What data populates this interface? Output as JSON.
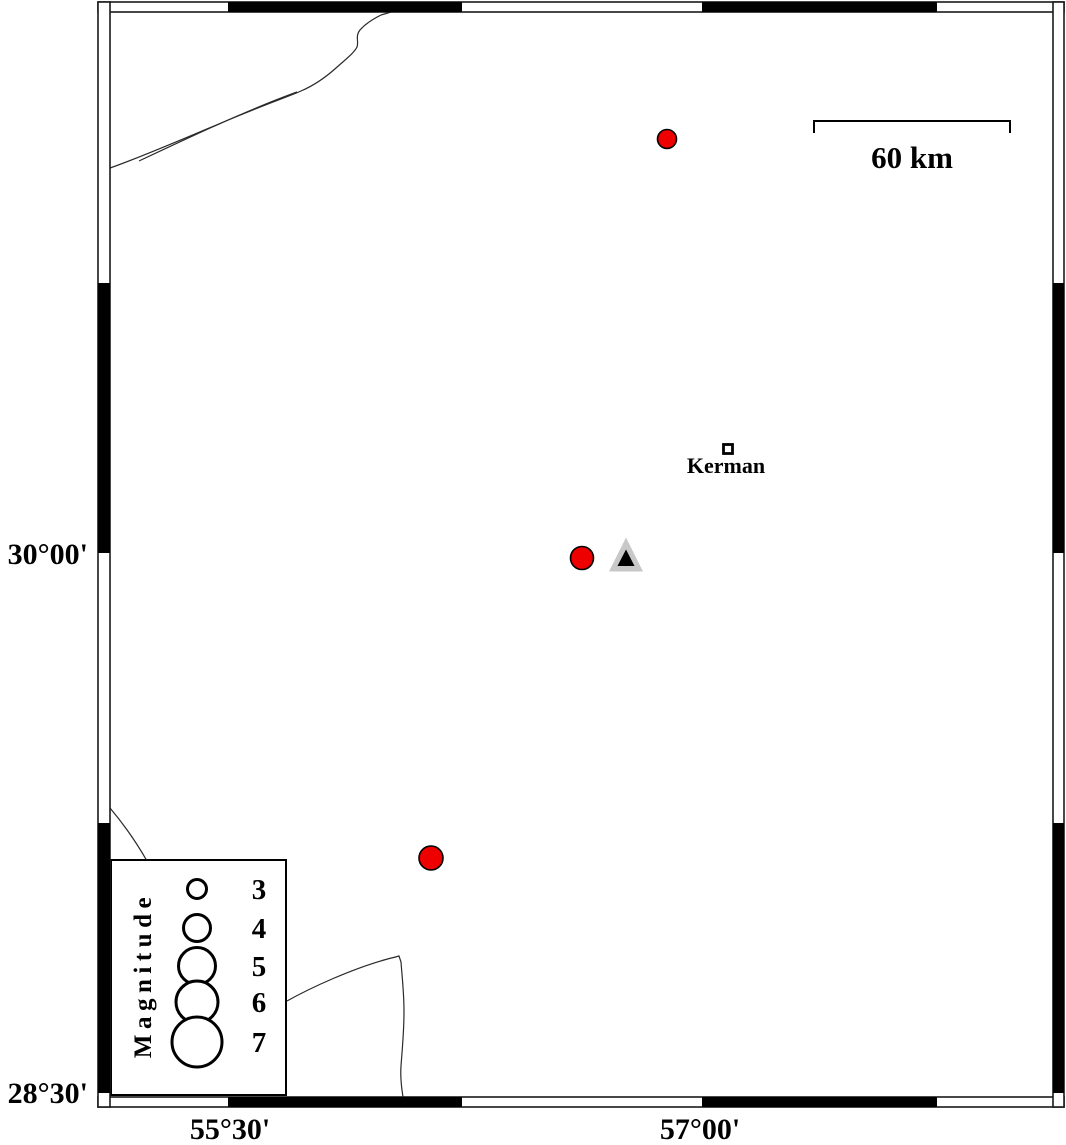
{
  "figure": {
    "type": "seismicity-map",
    "frame": {
      "left_labels": [
        {
          "text": "30°00'",
          "y": 553
        },
        {
          "text": "28°30'",
          "y": 1092
        }
      ],
      "bottom_labels": [
        {
          "text": "55°30'",
          "x": 230
        },
        {
          "text": "57°00'",
          "x": 700
        }
      ]
    },
    "scale_bar": {
      "label": "60 km"
    },
    "city": {
      "label": "Kerman",
      "x": 727,
      "y": 449,
      "approx_lon_deg": 57.08,
      "approx_lat_deg": 30.29
    },
    "station": {
      "x": 626,
      "y": 557,
      "approx_lon_deg": 56.76,
      "approx_lat_deg": 29.99
    },
    "earthquakes": [
      {
        "x": 667,
        "y": 139,
        "diameter": 19,
        "approx_lon_deg": 56.89,
        "approx_lat_deg": 31.15
      },
      {
        "x": 582,
        "y": 558,
        "diameter": 23,
        "approx_lon_deg": 56.62,
        "approx_lat_deg": 29.99
      },
      {
        "x": 431,
        "y": 858,
        "diameter": 24,
        "approx_lon_deg": 56.14,
        "approx_lat_deg": 29.15
      }
    ],
    "legend": {
      "title": "Magnitude",
      "entries": [
        {
          "label": "3",
          "diameter": 19,
          "y": 889
        },
        {
          "label": "4",
          "diameter": 27,
          "y": 928
        },
        {
          "label": "5",
          "diameter": 37,
          "y": 966
        },
        {
          "label": "6",
          "diameter": 42,
          "y": 1002
        },
        {
          "label": "7",
          "diameter": 50,
          "y": 1042
        }
      ]
    },
    "colors": {
      "earthquake_fill": "#ee0000",
      "station_fill": "#c8c8c8",
      "station_core": "#000000",
      "frame": "#000000",
      "background": "#ffffff"
    }
  }
}
